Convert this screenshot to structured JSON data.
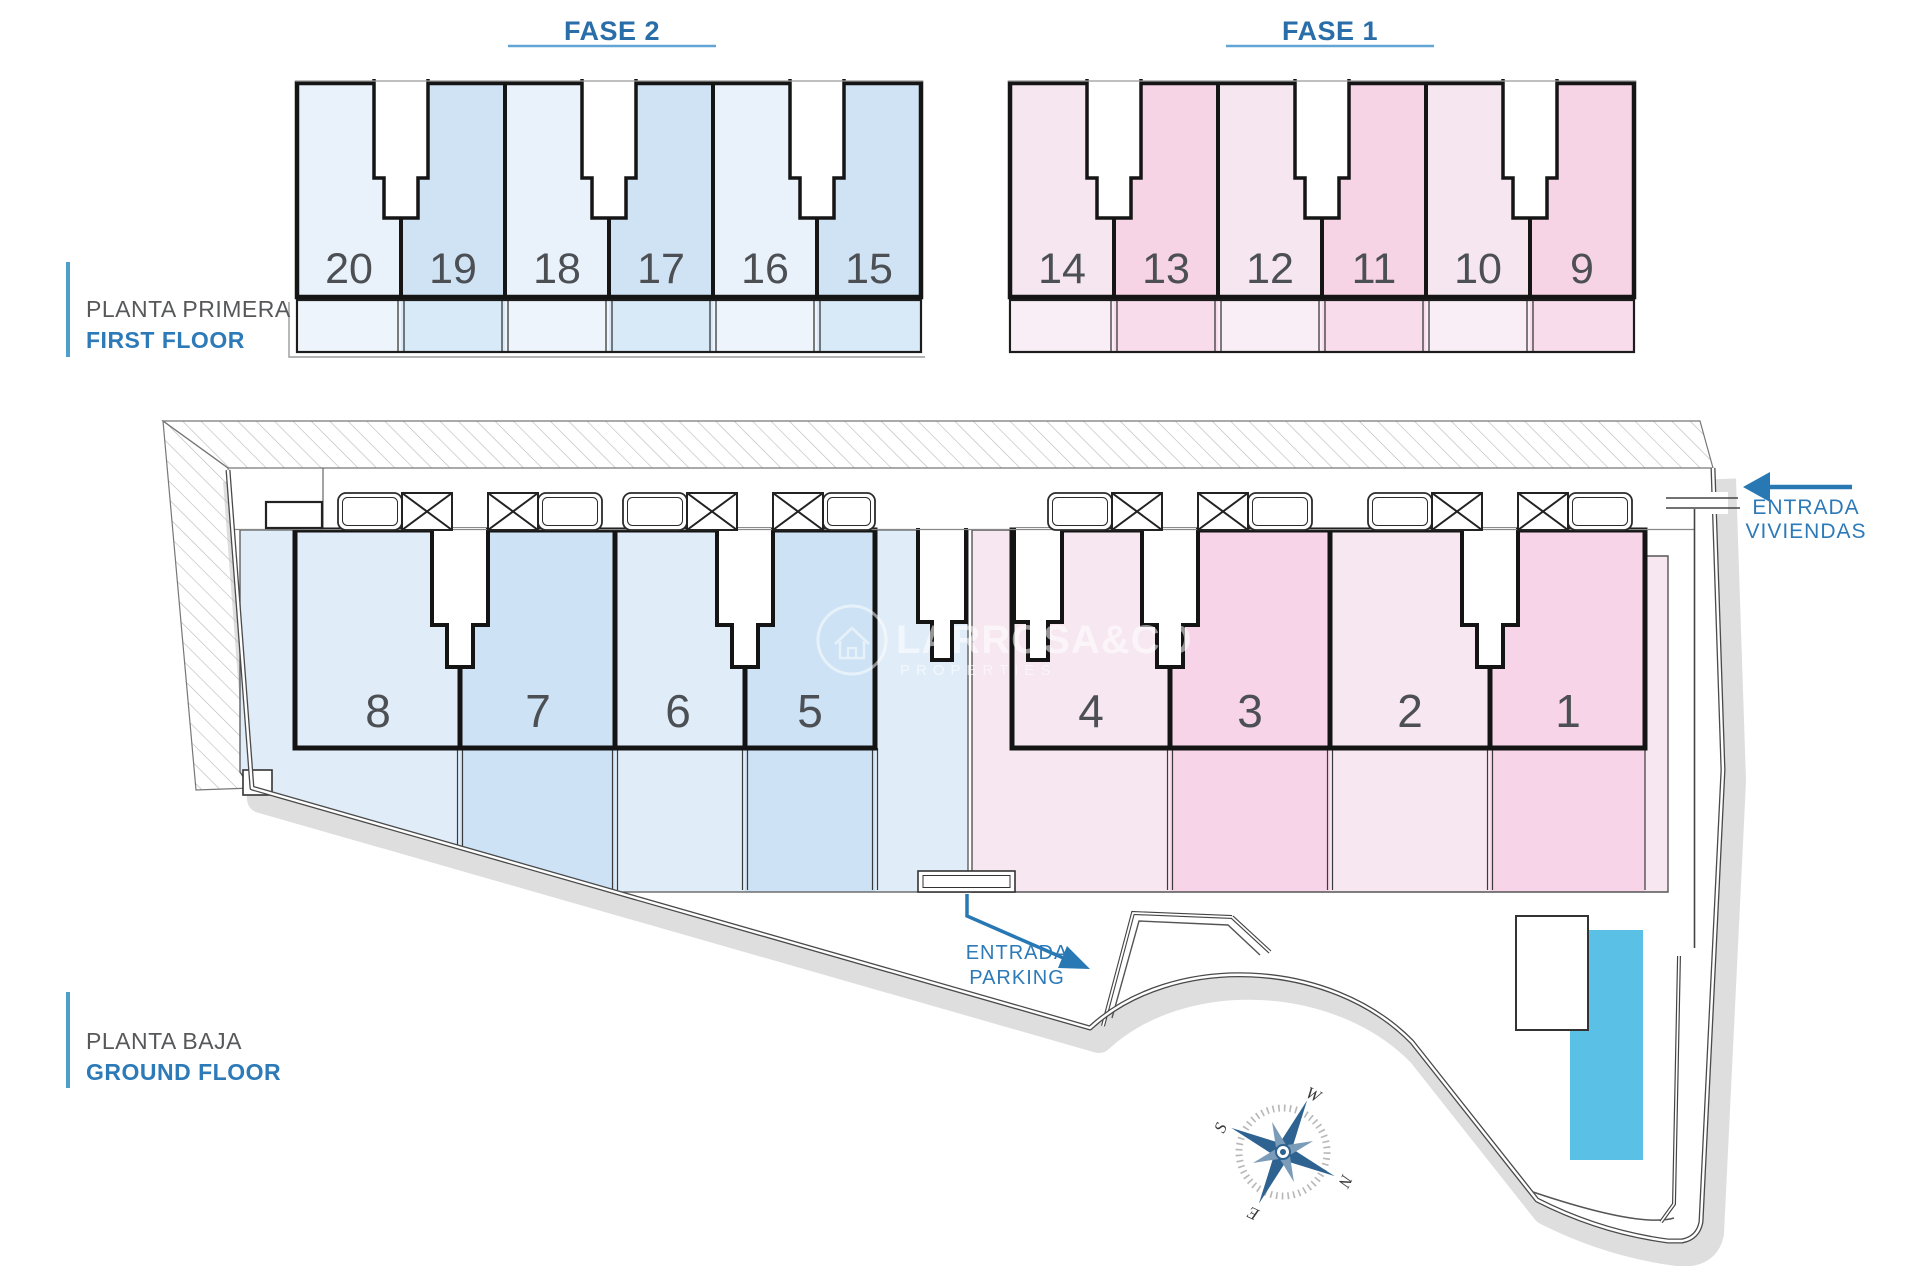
{
  "phases": {
    "fase2": "FASE 2",
    "fase1": "FASE 1"
  },
  "floors": {
    "first": {
      "title_es": "PLANTA PRIMERA",
      "title_en": "FIRST FLOOR",
      "fase2_units": [
        "20",
        "19",
        "18",
        "17",
        "16",
        "15"
      ],
      "fase1_units": [
        "14",
        "13",
        "12",
        "11",
        "10",
        "9"
      ]
    },
    "ground": {
      "title_es": "PLANTA BAJA",
      "title_en": "GROUND FLOOR",
      "fase2_units": [
        "8",
        "7",
        "6",
        "5"
      ],
      "fase1_units": [
        "4",
        "3",
        "2",
        "1"
      ]
    }
  },
  "entrances": {
    "homes": {
      "line1": "ENTRADA",
      "line2": "VIVIENDAS"
    },
    "parking": {
      "line1": "ENTRADA",
      "line2": "PARKING"
    }
  },
  "compass": {
    "north": "N",
    "east": "E",
    "south": "S",
    "west": "W"
  },
  "watermark": {
    "name": "LARROSA&CO",
    "tagline": "PROPERTIES"
  },
  "colors": {
    "fase2_light": "#e9f1fa",
    "fase2_dark": "#cfe3f5",
    "fase1_light": "#f5e6ef",
    "fase1_dark": "#f7d3e6",
    "pool": "#5ac0e6",
    "accent": "#2d7ab8"
  }
}
